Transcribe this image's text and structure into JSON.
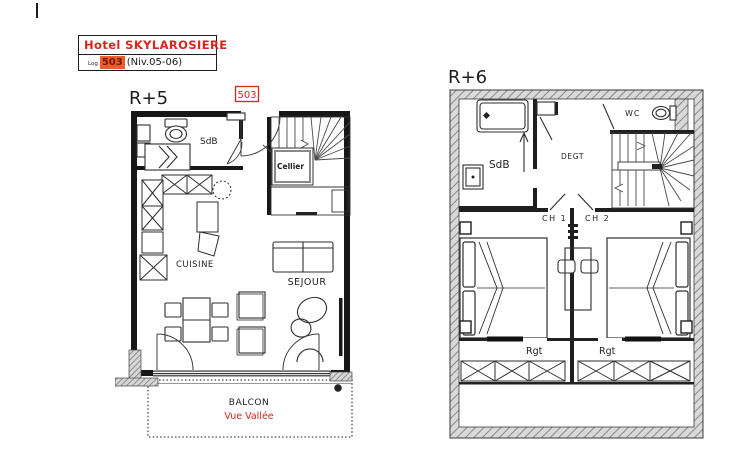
{
  "title_block": {
    "hotel": "Hotel SKYLAROSIERE",
    "log_label": "Log",
    "unit": "503",
    "level": "(Niv.05-06)"
  },
  "plans": {
    "r5": {
      "floor_label": "R+5",
      "unit_tag": "503",
      "rooms": {
        "sdb": "SdB",
        "cellier": "Cellier",
        "cuisine": "CUISINE",
        "sejour": "SEJOUR"
      },
      "balcony": {
        "name": "BALCON",
        "view": "Vue Vallée"
      }
    },
    "r6": {
      "floor_label": "R+6",
      "rooms": {
        "sdb": "SdB",
        "wc": "WC",
        "degt": "DEGT",
        "ch1": "CH 1",
        "ch2": "CH 2",
        "rgt_left": "Rgt",
        "rgt_right": "Rgt"
      }
    }
  },
  "colors": {
    "accent_red": "#d9251c",
    "highlight_bg": "#e85f28",
    "highlight_text": "#7c1403",
    "wall_black": "#171717",
    "hatch_gray": "#7f7f7f"
  }
}
